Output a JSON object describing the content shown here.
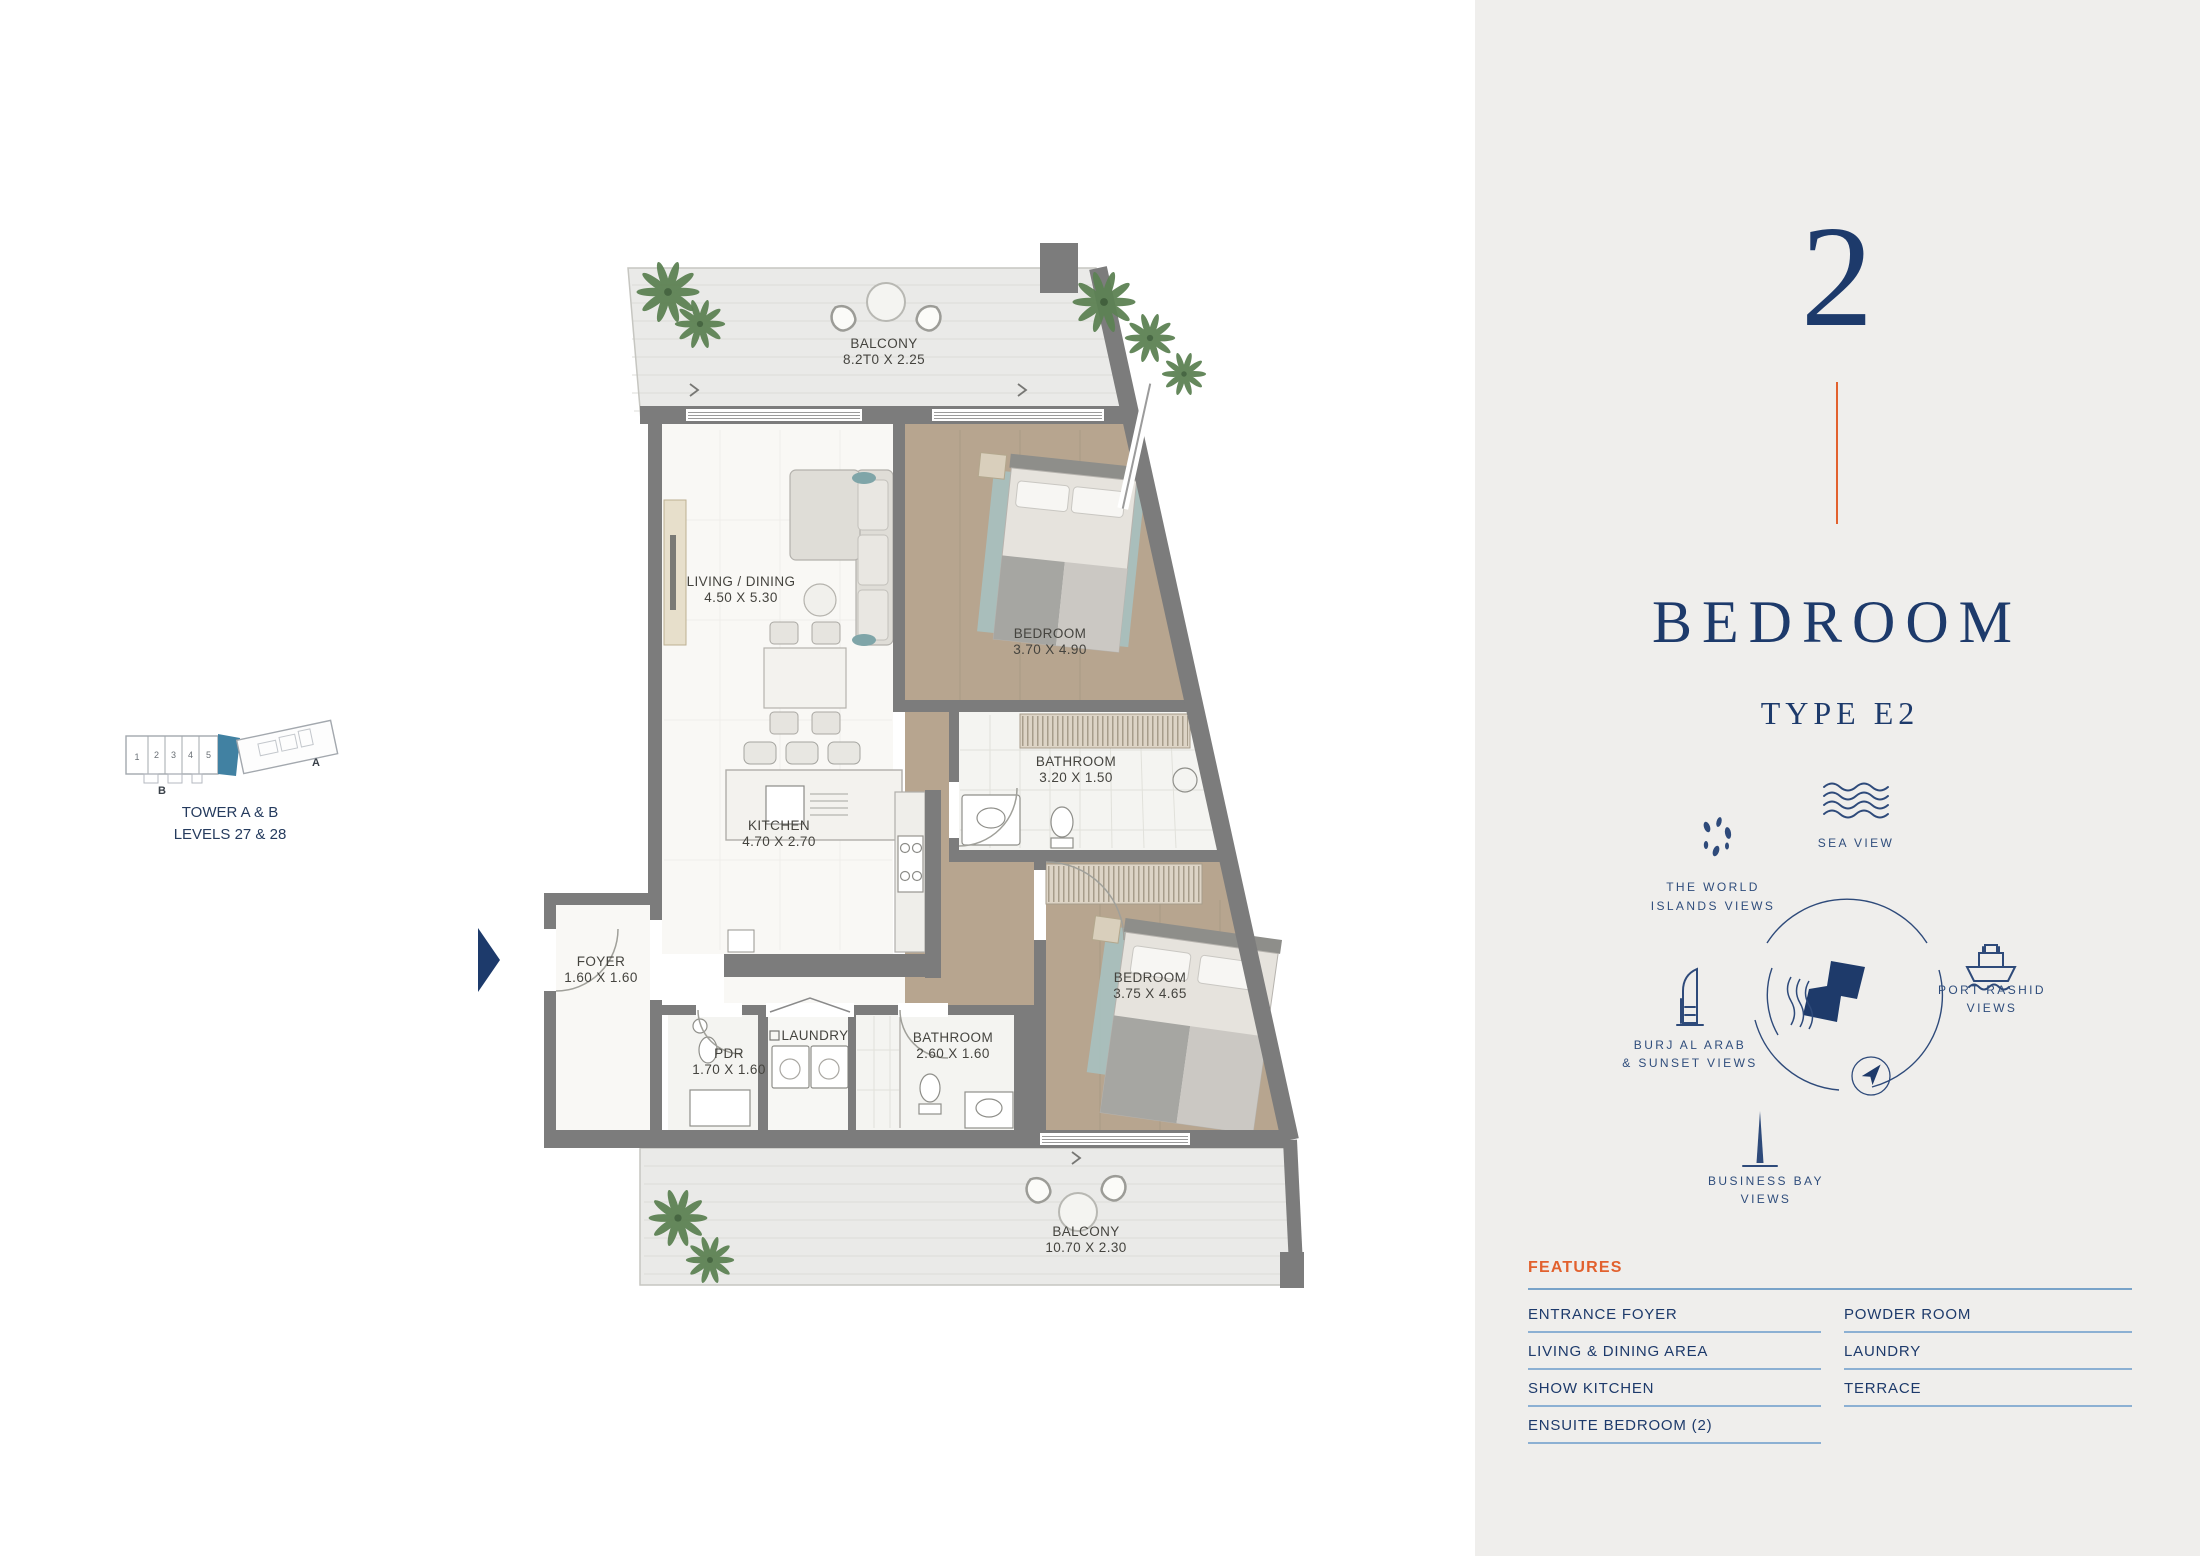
{
  "panel": {
    "number": "2",
    "title": "BEDROOM",
    "subtitle": "TYPE E2",
    "views": {
      "sea": {
        "line1": "SEA VIEW"
      },
      "world": {
        "line1": "THE WORLD",
        "line2": "ISLANDS VIEWS"
      },
      "port": {
        "line1": "PORT RASHID",
        "line2": "VIEWS"
      },
      "burj": {
        "line1": "BURJ AL ARAB",
        "line2": "& SUNSET VIEWS"
      },
      "bay": {
        "line1": "BUSINESS BAY",
        "line2": "VIEWS"
      }
    },
    "features": {
      "heading": "FEATURES",
      "left": [
        "ENTRANCE FOYER",
        "LIVING & DINING AREA",
        "SHOW KITCHEN",
        "ENSUITE BEDROOM (2)"
      ],
      "right": [
        "POWDER ROOM",
        "LAUNDRY",
        "TERRACE"
      ]
    }
  },
  "keymap": {
    "title_line1": "TOWER A & B",
    "title_line2": "LEVELS 27 & 28",
    "units": [
      "1",
      "2",
      "3",
      "4",
      "5"
    ],
    "wing_a": "A",
    "wing_b": "B"
  },
  "plan": {
    "balcony_top": {
      "name": "BALCONY",
      "dims": "8.2T0 X 2.25"
    },
    "living": {
      "name": "LIVING / DINING",
      "dims": "4.50 X 5.30"
    },
    "bedroom1": {
      "name": "BEDROOM",
      "dims": "3.70 X 4.90"
    },
    "bathroom1": {
      "name": "BATHROOM",
      "dims": "3.20 X 1.50"
    },
    "kitchen": {
      "name": "KITCHEN",
      "dims": "4.70 X 2.70"
    },
    "foyer": {
      "name": "FOYER",
      "dims": "1.60 X 1.60"
    },
    "pdr": {
      "name": "PDR",
      "dims": "1.70 X 1.60"
    },
    "laundry": {
      "name": "LAUNDRY"
    },
    "bathroom2": {
      "name": "BATHROOM",
      "dims": "2.60 X 1.60"
    },
    "bedroom2": {
      "name": "BEDROOM",
      "dims": "3.75 X 4.65"
    },
    "balcony_bottom": {
      "name": "BALCONY",
      "dims": "10.70 X 2.30"
    }
  },
  "colors": {
    "navy": "#1d3a6b",
    "orange": "#e2612e",
    "panel_bg": "#efeeec",
    "underline_blue": "#8cb0d3",
    "wall_gray": "#7c7c7c",
    "keymap_highlight": "#4181a2",
    "rug_teal": "#a7c1c0",
    "wood_floor": "#b7a58f"
  }
}
